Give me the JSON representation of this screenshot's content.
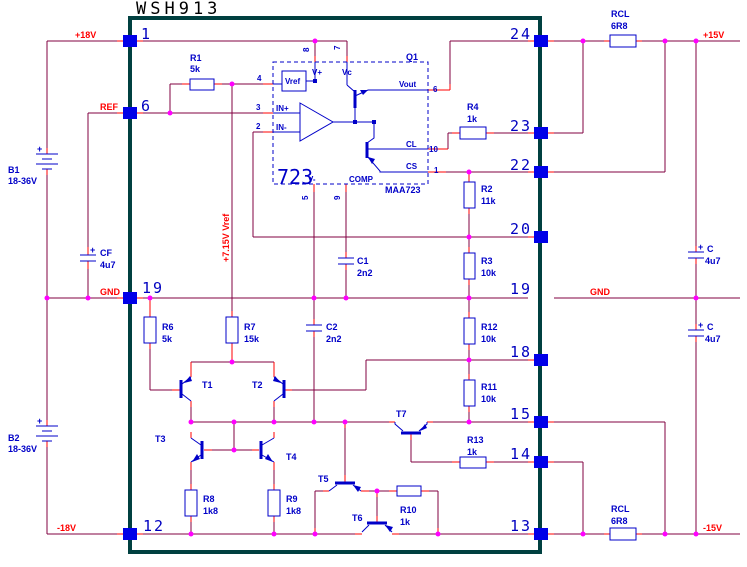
{
  "title": "WSH913",
  "nets": {
    "plus18": "+18V",
    "ref": "REF",
    "gnd_left": "GND",
    "gnd_right": "GND",
    "minus18": "-18V",
    "plus15": "+15V",
    "minus15": "-15V",
    "vref_rail": "+7.15V Vref"
  },
  "pins": {
    "left": {
      "p1": "1",
      "p6": "6",
      "p19": "19",
      "p12": "12"
    },
    "right": {
      "p24": "24",
      "p23": "23",
      "p22": "22",
      "p20": "20",
      "p19": "19",
      "p18": "18",
      "p15": "15",
      "p14": "14",
      "p13": "13"
    }
  },
  "ic723": {
    "big": "723",
    "part": "MAA723",
    "q1": "Q1",
    "vref": "Vref",
    "vplus": "V+",
    "vc": "Vc",
    "vminus": "V-",
    "comp": "COMP",
    "inplus": "IN+",
    "inminus": "IN-",
    "vout": "Vout",
    "cl": "CL",
    "cs": "CS",
    "pin8": "8",
    "pin7": "7",
    "pin4": "4",
    "pin3": "3",
    "pin2": "2",
    "pin5": "5",
    "pin9": "9",
    "pin6": "6",
    "pin10": "10",
    "pin1": "1"
  },
  "components": {
    "r1": {
      "ref": "R1",
      "value": "5k"
    },
    "r2": {
      "ref": "R2",
      "value": "11k"
    },
    "r3": {
      "ref": "R3",
      "value": "10k"
    },
    "r4": {
      "ref": "R4",
      "value": "1k"
    },
    "r6": {
      "ref": "R6",
      "value": "5k"
    },
    "r7": {
      "ref": "R7",
      "value": "15k"
    },
    "r8": {
      "ref": "R8",
      "value": "1k8"
    },
    "r9": {
      "ref": "R9",
      "value": "1k8"
    },
    "r10": {
      "ref": "R10",
      "value": "1k"
    },
    "r11": {
      "ref": "R11",
      "value": "10k"
    },
    "r12": {
      "ref": "R12",
      "value": "10k"
    },
    "r13": {
      "ref": "R13",
      "value": "1k"
    },
    "rcl_top": {
      "ref": "RCL",
      "value": "6R8"
    },
    "rcl_bottom": {
      "ref": "RCL",
      "value": "6R8"
    },
    "c1": {
      "ref": "C1",
      "value": "2n2"
    },
    "c2": {
      "ref": "C2",
      "value": "2n2"
    },
    "cf": {
      "plus": "+",
      "ref": "CF",
      "value": "4u7"
    },
    "c_top": {
      "plus": "+",
      "ref": "C",
      "value": "4u7"
    },
    "c_bottom": {
      "plus": "+",
      "ref": "C",
      "value": "4u7"
    },
    "b1": {
      "plus": "+",
      "ref": "B1",
      "value": "18-36V"
    },
    "b2": {
      "plus": "+",
      "ref": "B2",
      "value": "18-36V"
    },
    "t1": {
      "ref": "T1"
    },
    "t2": {
      "ref": "T2"
    },
    "t3": {
      "ref": "T3"
    },
    "t4": {
      "ref": "T4"
    },
    "t5": {
      "ref": "T5"
    },
    "t6": {
      "ref": "T6"
    },
    "t7": {
      "ref": "T7"
    }
  },
  "colors": {
    "wire": "#800040",
    "lead": "#ff0000",
    "component_blue": "#0000c8",
    "junction": "#ff00ff",
    "module_border": "#004040",
    "pin_square": "#0000e8",
    "net_label": "#ff0000",
    "title_text": "#000000"
  }
}
